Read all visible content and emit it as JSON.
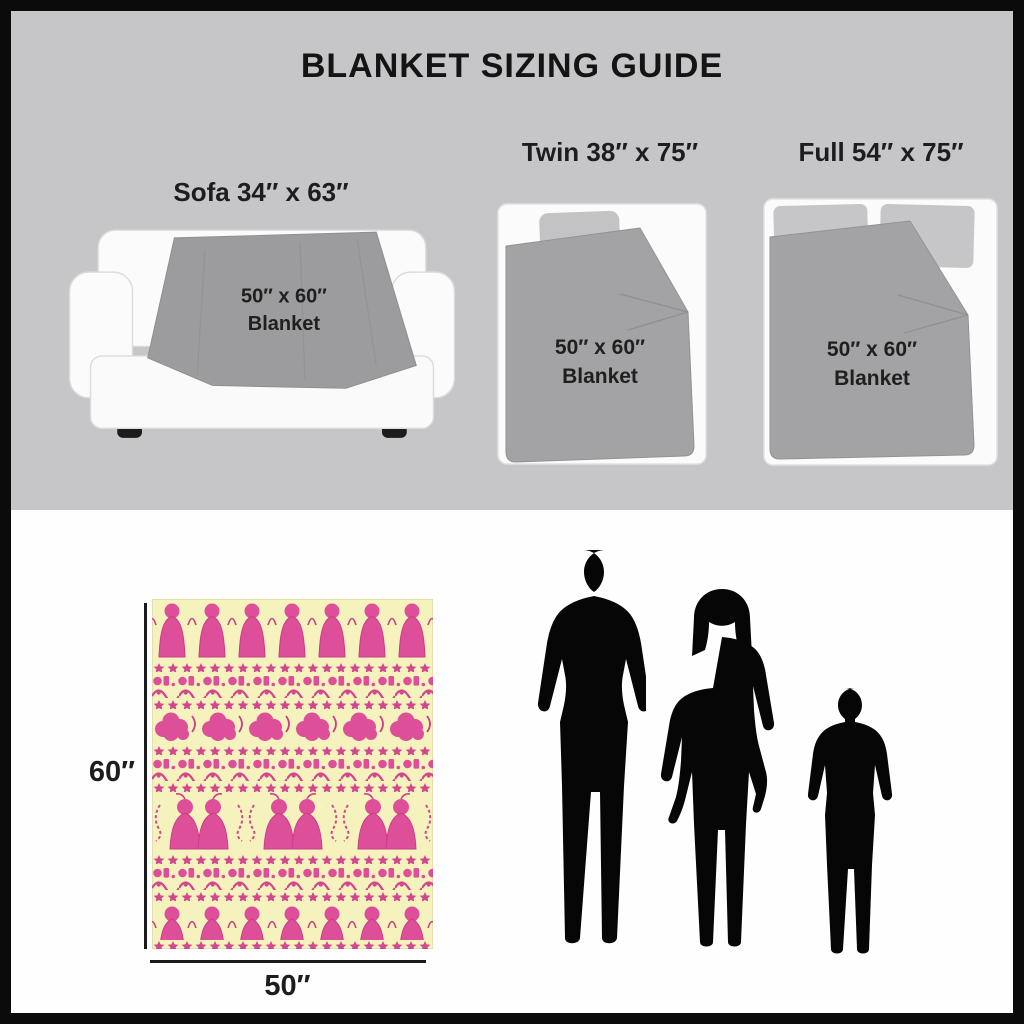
{
  "title": "BLANKET SIZING GUIDE",
  "items": {
    "sofa": {
      "label": "Sofa 34″ x 63″",
      "blanket_size": "50″ x 60″",
      "blanket_word": "Blanket"
    },
    "twin": {
      "label": "Twin 38″ x 75″",
      "blanket_size": "50″ x 60″",
      "blanket_word": "Blanket"
    },
    "full": {
      "label": "Full 54″ x 75″",
      "blanket_size": "50″ x 60″",
      "blanket_word": "Blanket"
    }
  },
  "scale_figure": {
    "blanket_height_label": "60″",
    "blanket_width_label": "50″",
    "silhouettes": [
      "adult-man",
      "adult-woman",
      "child"
    ]
  },
  "colors": {
    "background_top": "#C6C6C8",
    "background_bottom": "#FEFEFE",
    "frame": "#0B0B0B",
    "blanket_gray": "#A3A3A5",
    "pattern_pink": "#DE4F99",
    "pattern_background": "#F6F2BE",
    "silhouette": "#060606",
    "text": "#1D1D1F"
  }
}
